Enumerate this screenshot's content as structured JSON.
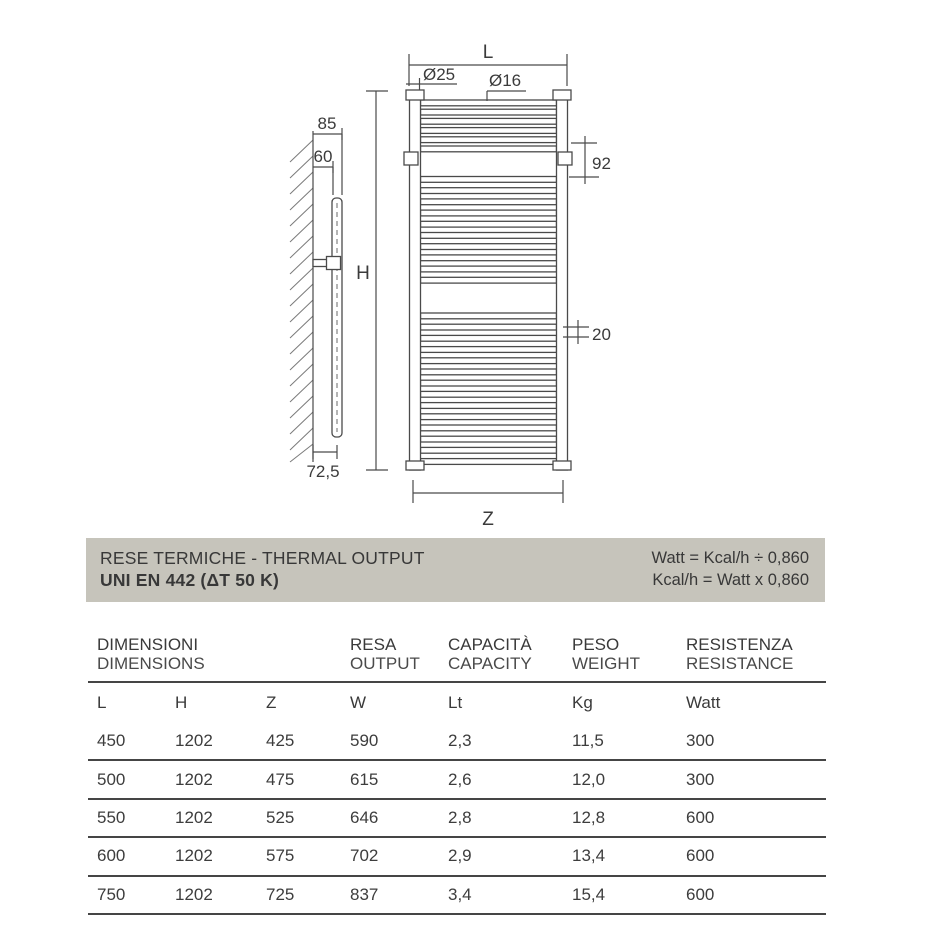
{
  "drawing": {
    "labels": {
      "width_letter": "L",
      "height_letter": "H",
      "rail_width_letter": "Z",
      "tube_diameter": "Ø25",
      "rung_diameter": "Ø16",
      "bracket_offset": "92",
      "rung_pitch": "20",
      "wall_depth_outer": "85",
      "wall_depth_inner": "60",
      "bottom_depth": "72,5"
    },
    "rung_groups": [
      6,
      10,
      14
    ]
  },
  "banner": {
    "bg_color": "#c6c4bb",
    "title_line1": "RESE TERMICHE - THERMAL OUTPUT",
    "title_line2": "UNI EN 442 (ΔT 50 K)",
    "formula_line1": "Watt = Kcal/h ÷ 0,860",
    "formula_line2": "Kcal/h = Watt x 0,860"
  },
  "table": {
    "group_headers": [
      {
        "it": "DIMENSIONI",
        "en": "DIMENSIONS"
      },
      {
        "it": "RESA",
        "en": "OUTPUT"
      },
      {
        "it": "CAPACITÀ",
        "en": "CAPACITY"
      },
      {
        "it": "PESO",
        "en": "WEIGHT"
      },
      {
        "it": "RESISTENZA",
        "en": "RESISTANCE"
      }
    ],
    "columns": [
      "L",
      "H",
      "Z",
      "W",
      "Lt",
      "Kg",
      "Watt"
    ],
    "rows": [
      [
        "450",
        "1202",
        "425",
        "590",
        "2,3",
        "11,5",
        "300"
      ],
      [
        "500",
        "1202",
        "475",
        "615",
        "2,6",
        "12,0",
        "300"
      ],
      [
        "550",
        "1202",
        "525",
        "646",
        "2,8",
        "12,8",
        "600"
      ],
      [
        "600",
        "1202",
        "575",
        "702",
        "2,9",
        "13,4",
        "600"
      ],
      [
        "750",
        "1202",
        "725",
        "837",
        "3,4",
        "15,4",
        "600"
      ]
    ]
  }
}
